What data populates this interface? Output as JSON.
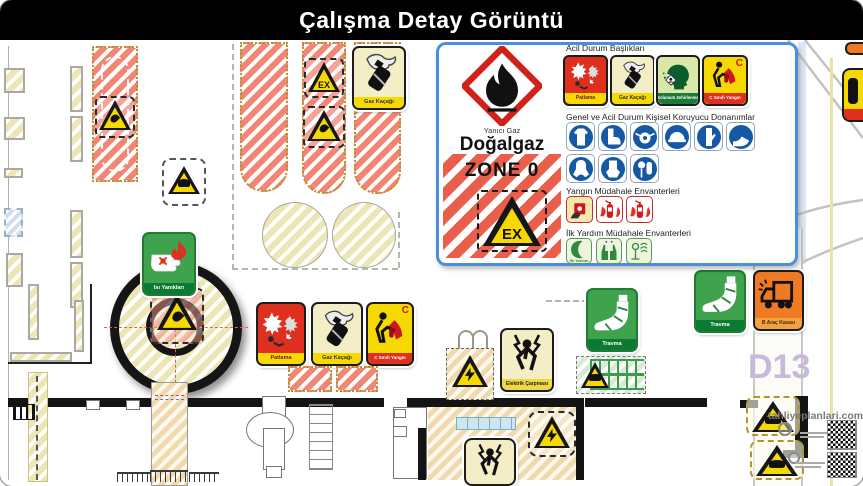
{
  "window": {
    "title": "Çalışma Detay Görüntü"
  },
  "info_panel": {
    "ghs": {
      "icon": "ghs-flame-pictogram",
      "caption": "Yanıcı Gaz",
      "substance": "Doğalgaz"
    },
    "zone": {
      "label": "ZONE 0",
      "symbol": "EX",
      "icon": "ex-explosive-atmosphere-triangle"
    },
    "emergency": {
      "heading": "Acil Durum Başlıkları",
      "items": [
        {
          "label": "Patlama",
          "icon": "explosion-icon",
          "bg": "#df2f1e"
        },
        {
          "label": "Gaz Kaçağı",
          "icon": "gas-leak-icon",
          "bg": "#f3eec5"
        },
        {
          "label": "Solunum Zehirlenme",
          "icon": "inhalation-poisoning-icon",
          "bg": "#d9e8a8"
        },
        {
          "label": "C Sınıfı Yangın",
          "icon": "class-c-fire-icon",
          "bg": "#f6d900",
          "class_letter": "C"
        }
      ]
    },
    "ppe": {
      "heading": "Genel ve Acil Durum Kişisel Koruyucu Donanımlar",
      "color": "#1559a6",
      "icons": [
        "protective-clothing-icon",
        "safety-boots-icon",
        "respirator-mask-icon",
        "safety-helmet-icon",
        "protective-gloves-icon",
        "safety-shoes-icon",
        "protective-suit-icon",
        "chemical-gloves-icon",
        "breathing-apparatus-icon"
      ]
    },
    "fire": {
      "heading": "Yangın Müdahale Envanterleri",
      "icons": [
        "fire-alarm-call-point-icon",
        "fire-extinguisher-icon",
        "fire-extinguisher-cabinet-icon"
      ]
    },
    "first_aid": {
      "heading": "İlk Yardım Müdahale Envanterleri",
      "first_label": "İlk Yardım",
      "icons": [
        "first-aid-crescent-icon",
        "protective-hands-icon",
        "emergency-eyewash-icon"
      ]
    }
  },
  "plan": {
    "signs": {
      "gas_leak_top": "Gaz Kaçağı",
      "heat_burns": "Isı Yanıkları",
      "explosion": "Patlama",
      "gas_leak_mid": "Gaz Kaçağı",
      "class_c_fire": "C Sınıfı Yangın",
      "class_letter": "C",
      "electric_shock": "Elektrik Çarpması",
      "trauma_1": "Travma",
      "trauma_2": "Travma",
      "vehicle_accident": "B Araç Kazası"
    },
    "symbols": {
      "ex": "EX"
    },
    "road_label": "D13",
    "watermark": "tahliyeplanlari.com"
  },
  "colors": {
    "banner": "#000000",
    "panel_border": "#4a90d9",
    "hazard_red": "#df2f1e",
    "warning_yellow": "#f6d900",
    "safety_green": "#3fa24c",
    "ppe_blue": "#1559a6",
    "accident_orange": "#ee7a23",
    "road_label_purple": "#c6b9d9"
  }
}
